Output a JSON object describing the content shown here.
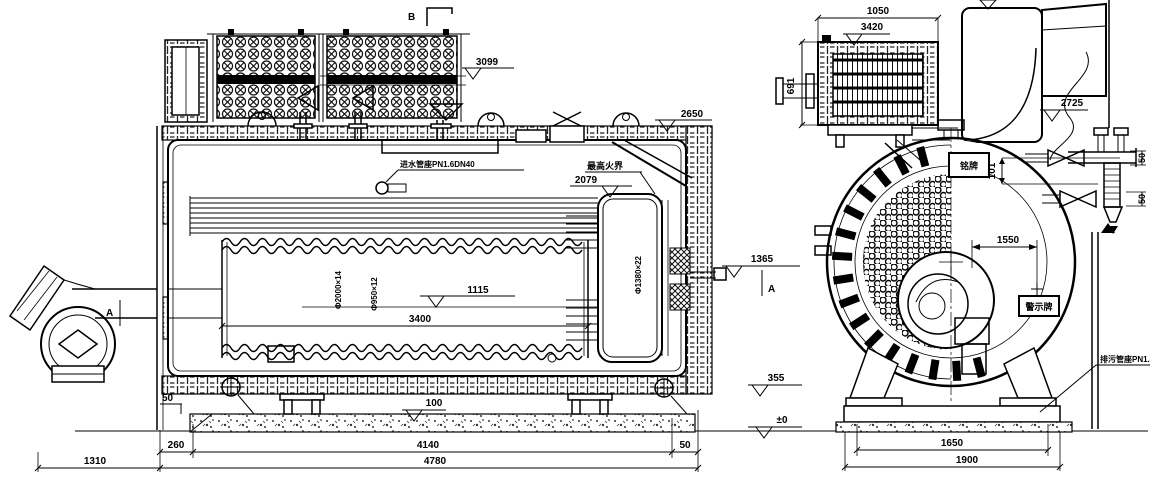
{
  "drawing_title": "boiler-general-arrangement-drawing",
  "side_view": {
    "section_b": "B",
    "section_a_left": "A",
    "section_a_right": "A",
    "elev_3099": "3099",
    "elev_2650": "2650",
    "feedwater_label": "进水管座PN1.6DN40",
    "fire_limit_label": "最高火界",
    "elev_2079": "2079",
    "shell_dim": "Φ2000×14",
    "furnace_dim": "Φ950×12",
    "rear_tube_dim": "Φ1380×22",
    "elev_1115": "1115",
    "dim_3400": "3400",
    "elev_1365": "1365",
    "elev_355": "355",
    "elev_zero": "±0",
    "dim_50_foundation": "50",
    "elev_100": "100",
    "dim_260": "260",
    "dim_4140": "4140",
    "dim_50_right": "50",
    "dim_4780": "4780",
    "dim_1310": "1310"
  },
  "end_view": {
    "dim_1050": "1050",
    "elev_3420": "3420",
    "dim_691": "691",
    "elev_2725": "2725",
    "nameplate_label": "铭牌",
    "dim_101": "101",
    "dim_50_upper": "50",
    "dim_50_lower": "50",
    "dim_1550": "1550",
    "warning_sign_label": "警示牌",
    "blowdown_label": "排污管座PN1.6",
    "dim_1650": "1650",
    "dim_1900": "1900"
  }
}
